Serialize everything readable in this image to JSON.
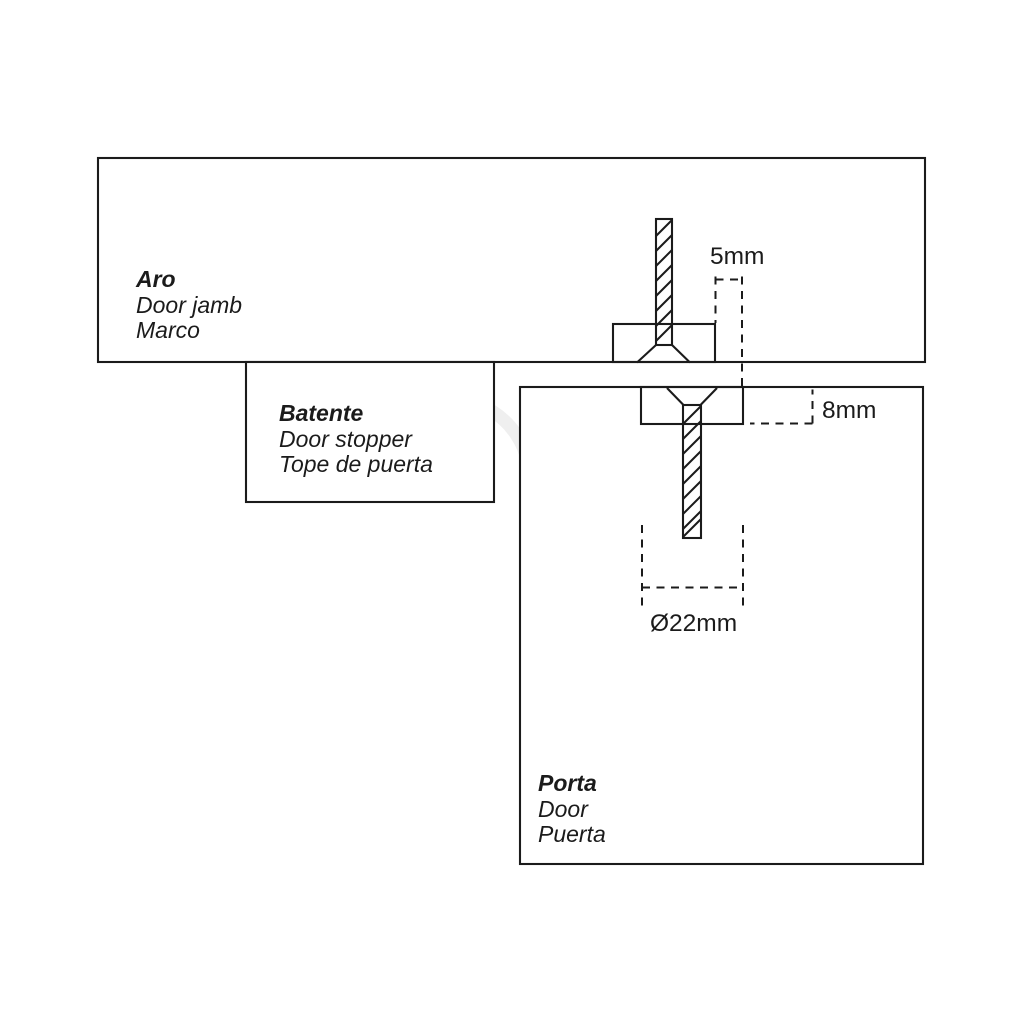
{
  "diagram": {
    "colors": {
      "background": "#ffffff",
      "line": "#1b1b1b",
      "watermark": "#efefef"
    },
    "parts": [
      {
        "id": "door-jamb",
        "name": "Aro",
        "translation_en": "Door jamb",
        "translation_es": "Marco"
      },
      {
        "id": "door-stopper",
        "name": "Batente",
        "translation_en": "Door stopper",
        "translation_es": "Tope de puerta"
      },
      {
        "id": "door",
        "name": "Porta",
        "translation_en": "Door",
        "translation_es": "Puerta"
      }
    ],
    "dimensions": [
      {
        "id": "edge-offset",
        "value": "5mm"
      },
      {
        "id": "recess-depth",
        "value": "8mm"
      },
      {
        "id": "recess-diameter",
        "value": "Ø22mm"
      }
    ]
  }
}
